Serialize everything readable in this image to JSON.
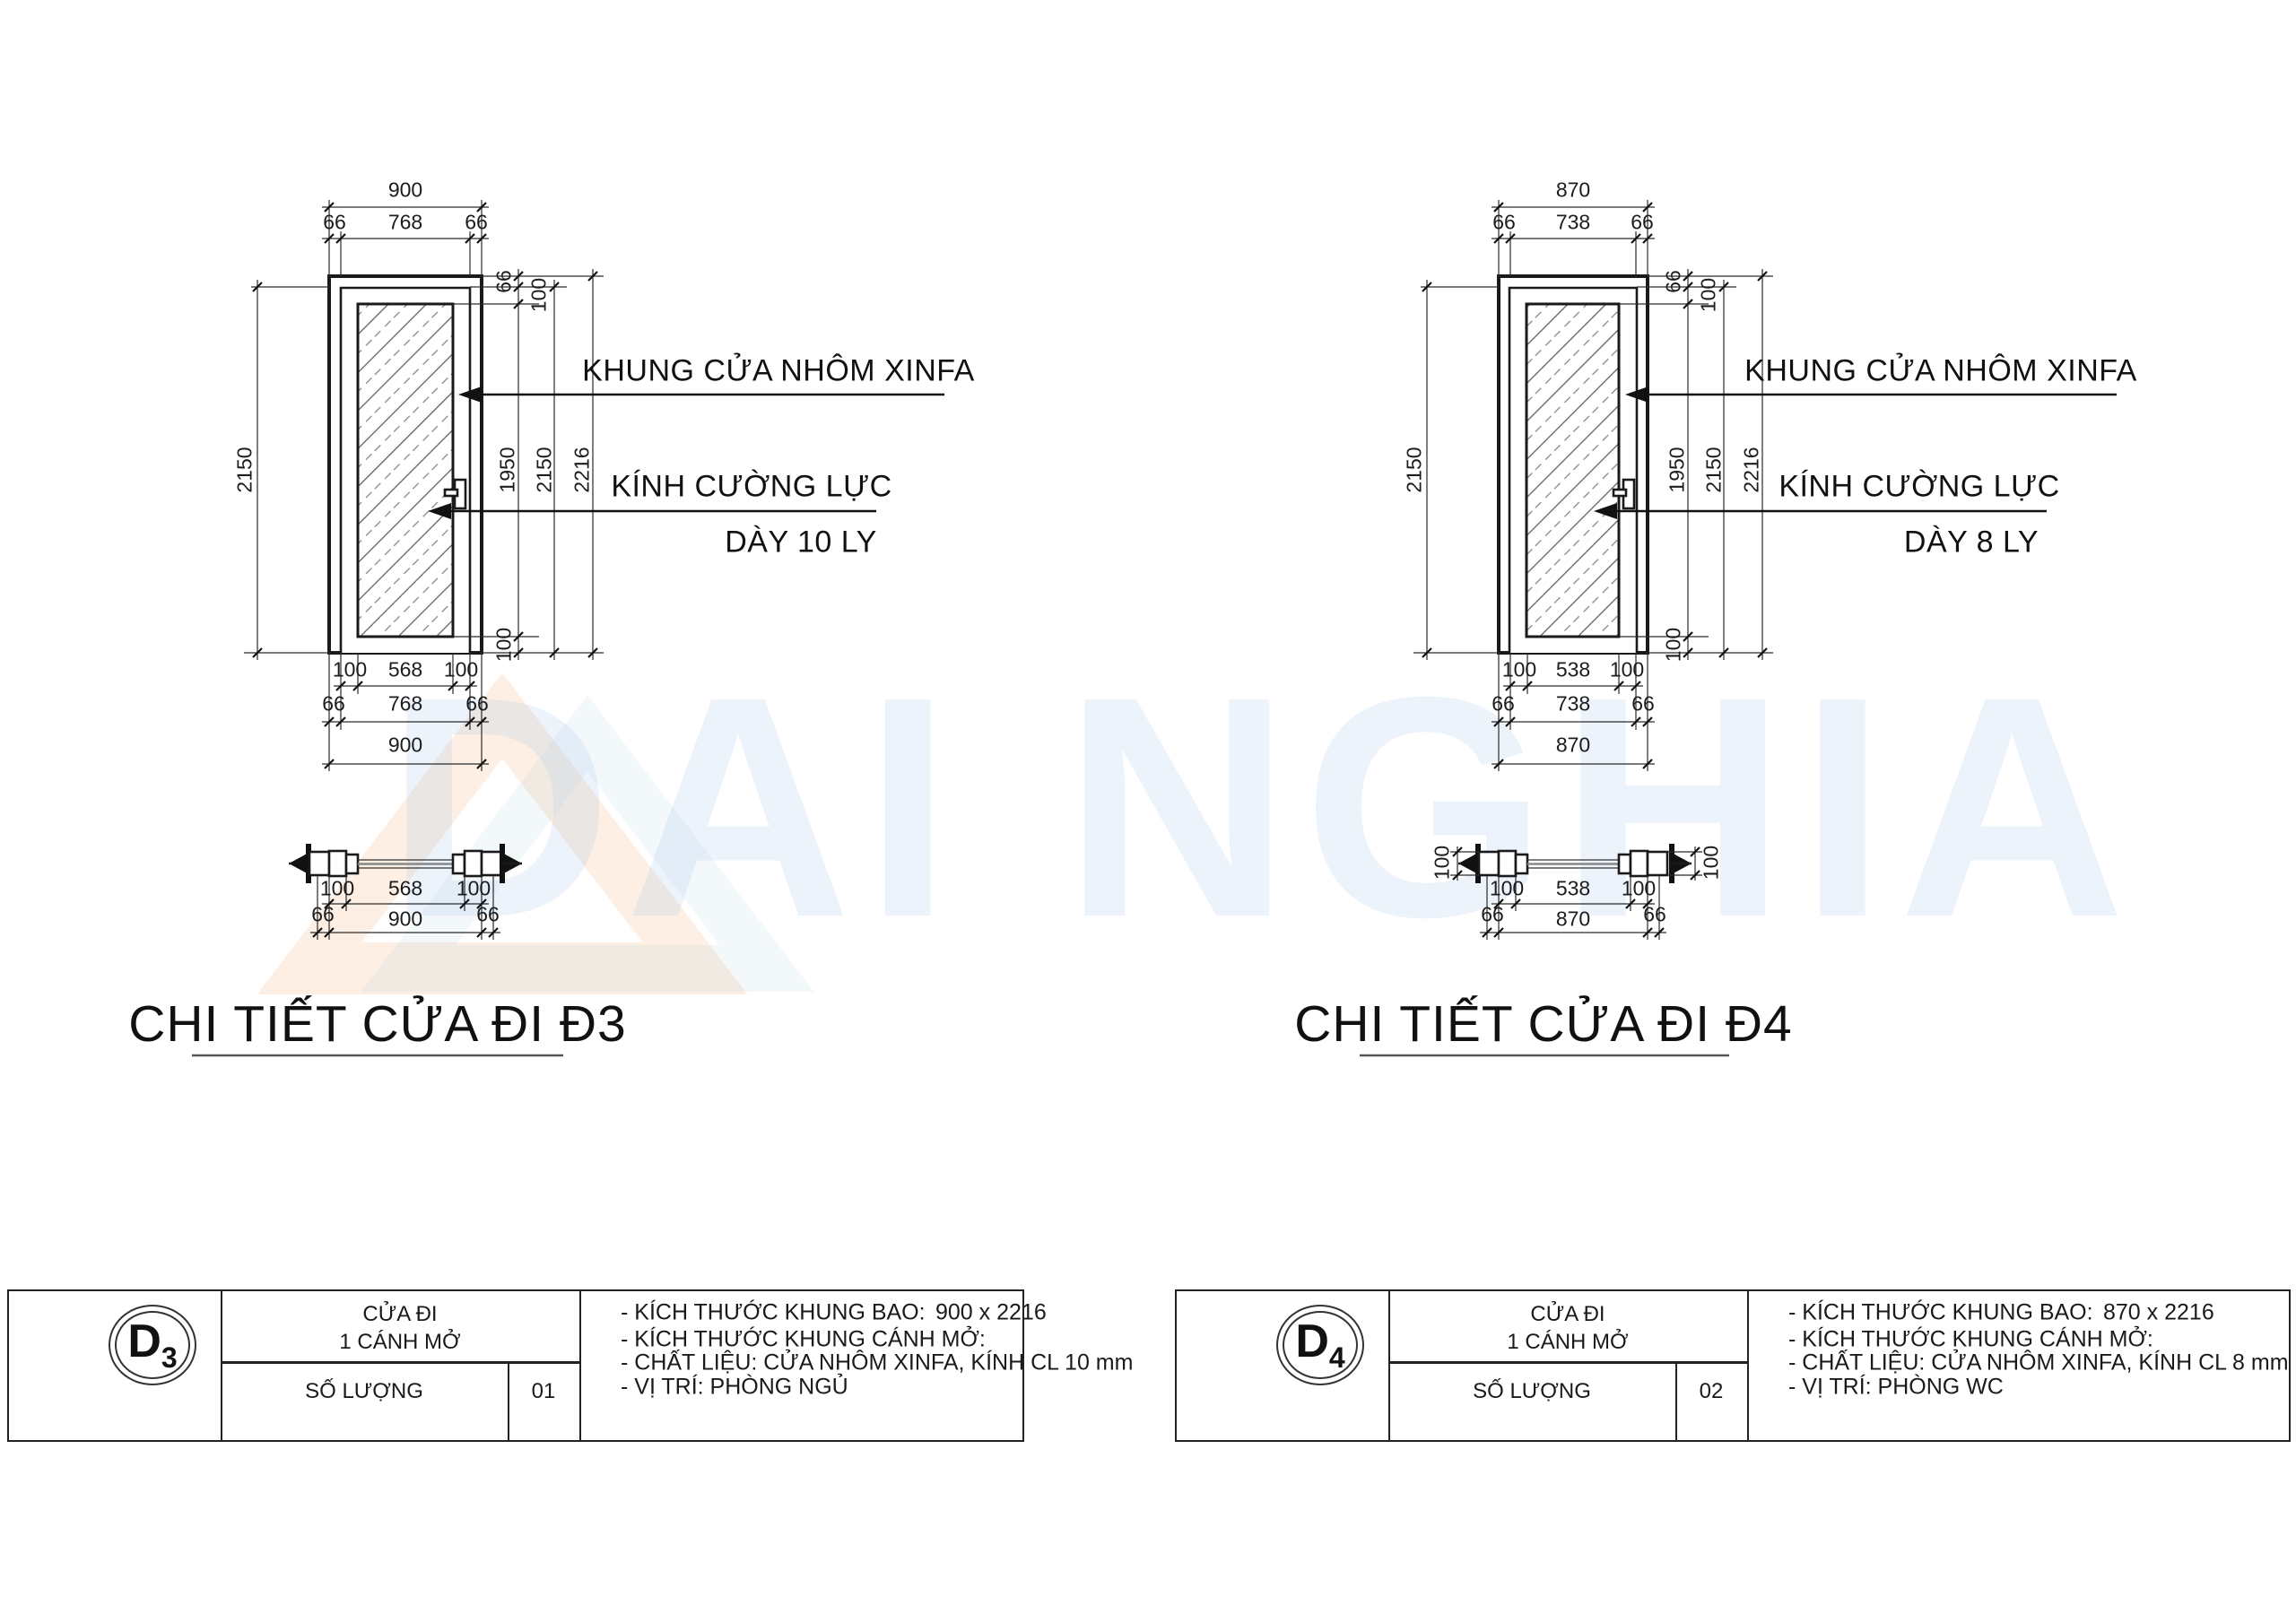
{
  "watermark": {
    "text": "DAI NGHIA"
  },
  "d3": {
    "title": "CHI TIẾT CỬA ĐI Đ3",
    "callouts": {
      "frame": "KHUNG CỬA NHÔM XINFA",
      "glass": "KÍNH  CƯỜNG LỰC",
      "glass2": "DÀY 10 LY"
    },
    "dims": {
      "top_total": "900",
      "top_l": "66",
      "top_m": "768",
      "top_r": "66",
      "bot1_l": "100",
      "bot1_m": "568",
      "bot1_r": "100",
      "bot2_l": "66",
      "bot2_m": "768",
      "bot2_r": "66",
      "bot_total": "900",
      "side_left": "2150",
      "r_t1": "66",
      "r_t2": "100",
      "r_glass": "1950",
      "r_leaf": "2150",
      "r_total": "2216",
      "r_b": "100",
      "sec1_l": "100",
      "sec1_m": "568",
      "sec1_r": "100",
      "sec2_l": "66",
      "sec2_m": "900",
      "sec2_r": "66"
    },
    "block": {
      "code": "D",
      "code_sub": "3",
      "type1": "CỬA ĐI",
      "type2": "1 CÁNH MỞ",
      "qty_label": "SỐ LƯỢNG",
      "qty": "01",
      "n1": "- KÍCH THƯỚC KHUNG BAO:",
      "n1v": "900 x 2216",
      "n2": "- KÍCH THƯỚC KHUNG CÁNH MỞ:",
      "n3": "- CHẤT LIỆU:  CỬA NHÔM XINFA, KÍNH  CL 10 mm",
      "n4": "- VỊ TRÍ:   PHÒNG NGỦ"
    }
  },
  "d4": {
    "title": "CHI TIẾT CỬA ĐI Đ4",
    "callouts": {
      "frame": "KHUNG CỬA NHÔM XINFA",
      "glass": "KÍNH  CƯỜNG LỰC",
      "glass2": "DÀY 8 LY"
    },
    "dims": {
      "top_total": "870",
      "top_l": "66",
      "top_m": "738",
      "top_r": "66",
      "bot1_l": "100",
      "bot1_m": "538",
      "bot1_r": "100",
      "bot2_l": "66",
      "bot2_m": "738",
      "bot2_r": "66",
      "bot_total": "870",
      "side_left": "2150",
      "r_t1": "66",
      "r_t2": "100",
      "r_glass": "1950",
      "r_leaf": "2150",
      "r_total": "2216",
      "r_b": "100",
      "sec_wall_l": "100",
      "sec_wall_r": "100",
      "sec1_l": "100",
      "sec1_m": "538",
      "sec1_r": "100",
      "sec2_l": "66",
      "sec2_m": "870",
      "sec2_r": "66"
    },
    "block": {
      "code": "D",
      "code_sub": "4",
      "type1": "CỬA ĐI",
      "type2": "1 CÁNH MỞ",
      "qty_label": "SỐ LƯỢNG",
      "qty": "02",
      "n1": "- KÍCH THƯỚC KHUNG BAO:",
      "n1v": "870 x 2216",
      "n2": "- KÍCH THƯỚC KHUNG CÁNH MỞ:",
      "n3": "- CHẤT LIỆU:  CỬA NHÔM XINFA, KÍNH  CL 8 mm DÁN DECAL MỜ",
      "n4": "- VỊ TRÍ:   PHÒNG WC"
    }
  }
}
